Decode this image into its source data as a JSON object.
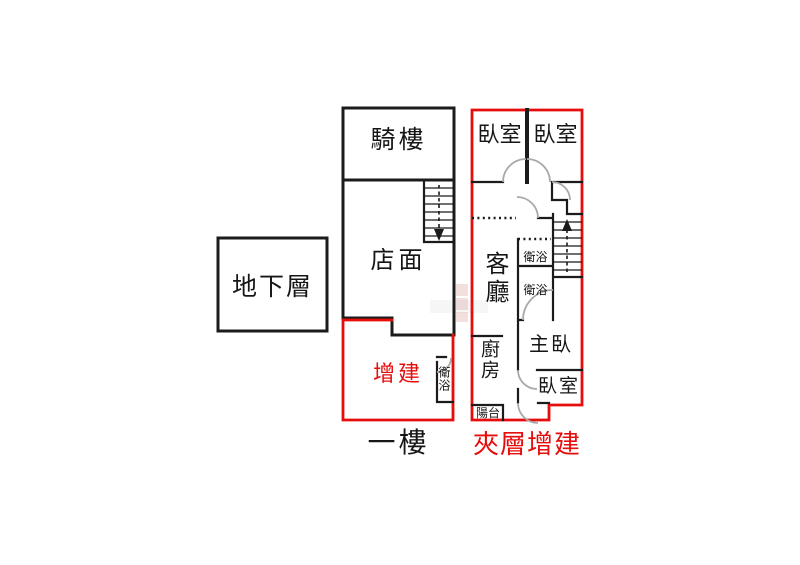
{
  "palette": {
    "wall": "#1b1b1b",
    "addition_red": "#e60d0d",
    "door_arc": "#a9a9a9",
    "ink": "#161616",
    "background": "#ffffff"
  },
  "basement": {
    "label": "地下層"
  },
  "floor1": {
    "caption": "一樓",
    "arcade": "騎樓",
    "storefront": "店面",
    "addition": "增建",
    "bathroom": "衛浴",
    "stairs_direction": "down"
  },
  "mezzanine": {
    "caption": "夾層增建",
    "bedroom_top_left": "臥室",
    "bedroom_top_right": "臥室",
    "living_room": "客廳",
    "bathroom_upper": "衛浴",
    "bathroom_lower": "衛浴",
    "master_bedroom": "主臥",
    "kitchen": "廚房",
    "bedroom_lower": "臥室",
    "balcony": "陽台",
    "stairs_direction": "up"
  }
}
